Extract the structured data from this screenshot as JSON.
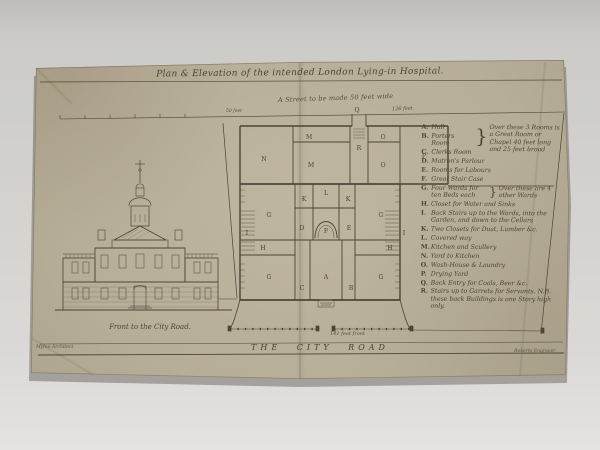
{
  "title": "Plan & Elevation of the intended London Lying-in Hospital.",
  "annotations": {
    "street_note": "A Street to be made 50 feet wide",
    "street_dim": "126 feet",
    "scale_label": "50 feet",
    "front_dim": "141 feet front",
    "road_label": "THE CITY ROAD",
    "elevation_caption": "Front to the City Road.",
    "credit_left": "Mylne Architect",
    "credit_right": "Roberts Engraver"
  },
  "legend": {
    "group_abc_note": "Over these 3 Rooms is a Great Room or Chapel 40 feet long and 25 feet broad",
    "items": [
      {
        "letter": "A",
        "label": "Hall"
      },
      {
        "letter": "B",
        "label": "Porters Room"
      },
      {
        "letter": "C",
        "label": "Clerks Room"
      },
      {
        "letter": "D",
        "label": "Matron's Parlour"
      },
      {
        "letter": "E",
        "label": "Rooms for Labours"
      },
      {
        "letter": "F",
        "label": "Great Stair Case"
      },
      {
        "letter": "G",
        "label": "Four Wards for ten Beds each",
        "note": "Over these are 4 other Wards"
      },
      {
        "letter": "H",
        "label": "Closet for Water and Sinks"
      },
      {
        "letter": "I",
        "label": "Back Stairs up to the Wards, into the Garden, and down to the Cellars"
      },
      {
        "letter": "K",
        "label": "Two Closets for Dust, Lumber &c."
      },
      {
        "letter": "L",
        "label": "Covered way"
      },
      {
        "letter": "M",
        "label": "Kitchen and Scullery"
      },
      {
        "letter": "N",
        "label": "Yard to Kitchen"
      },
      {
        "letter": "O",
        "label": "Wash-House & Laundry"
      },
      {
        "letter": "P",
        "label": "Drying Yard"
      },
      {
        "letter": "Q",
        "label": "Back Entry for Coals, Beer &c."
      },
      {
        "letter": "R",
        "label": "Stairs up to Garrets for Servants. N.B. these back Buildings is one Story high only."
      }
    ]
  },
  "plan": {
    "labels": [
      "N",
      "M",
      "M",
      "Q",
      "R",
      "O",
      "O",
      "P",
      "G",
      "K",
      "L",
      "K",
      "G",
      "D",
      "F",
      "E",
      "H",
      "G",
      "C",
      "A",
      "B",
      "G",
      "H",
      "I",
      "I"
    ]
  },
  "colors": {
    "paper": "#b7ae98",
    "ink": "#4c4434",
    "photo_bg": "#d4d3d0"
  }
}
